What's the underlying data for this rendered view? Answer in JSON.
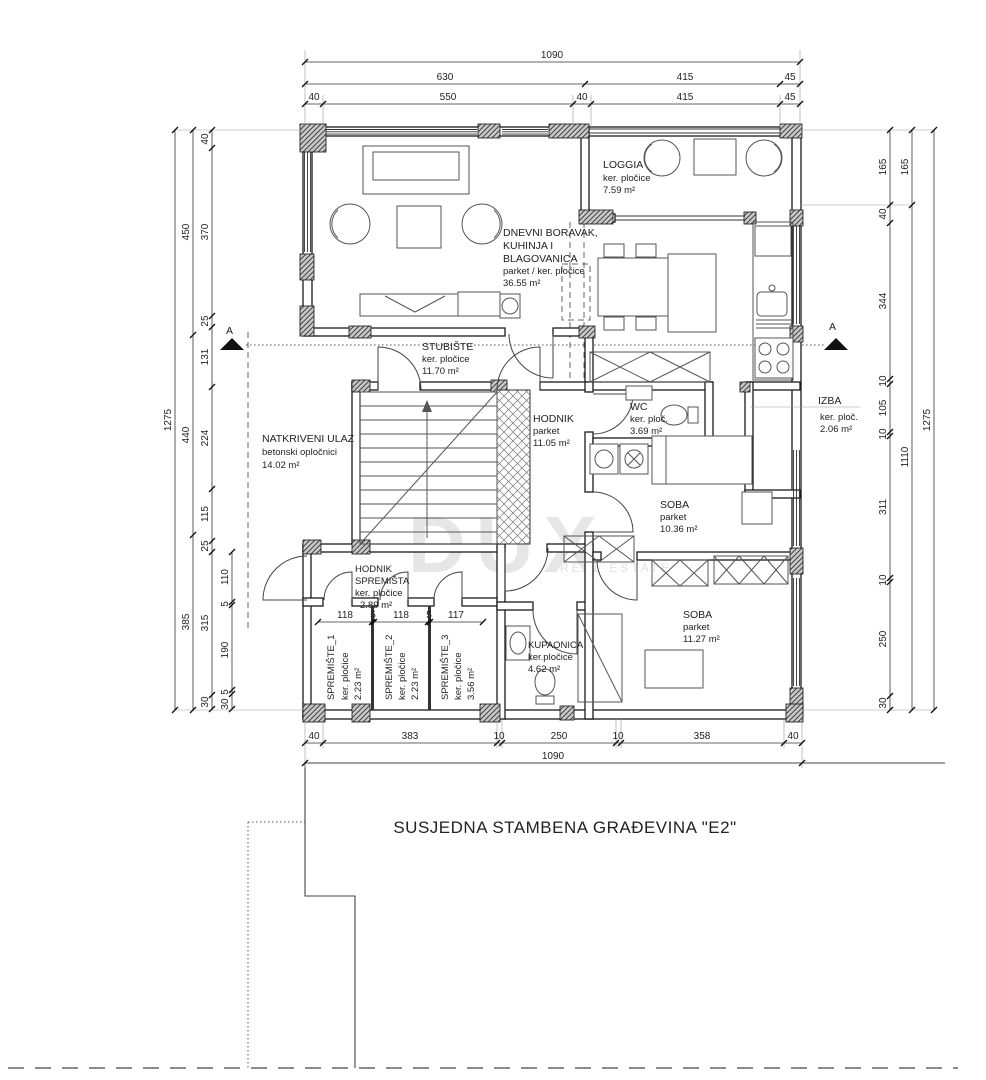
{
  "rooms": {
    "loggia": {
      "name": "LOGGIA",
      "floor": "ker. pločice",
      "area": "7.59 m²"
    },
    "living": {
      "name1": "DNEVNI BORAVAK,",
      "name2": "KUHINJA I",
      "name3": "BLAGOVANICA",
      "floor": "parket / ker. pločice",
      "area": "36.55 m²"
    },
    "stubiste": {
      "name": "STUBIŠTE",
      "floor": "ker. pločice",
      "area": "11.70 m²"
    },
    "natkriveni_ulaz": {
      "name": "NATKRIVENI ULAZ",
      "floor": "betonski opločnici",
      "area": "14.02 m²"
    },
    "hodnik": {
      "name": "HODNIK",
      "floor": "parket",
      "area": "11.05 m²"
    },
    "wc": {
      "name": "WC",
      "floor": "ker. ploč.",
      "area": "3.69 m²"
    },
    "izba": {
      "name": "IZBA",
      "floor": "ker. ploč.",
      "area": "2.06 m²"
    },
    "soba1": {
      "name": "SOBA",
      "floor": "parket",
      "area": "10.36 m²"
    },
    "soba2": {
      "name": "SOBA",
      "floor": "parket",
      "area": "11.27 m²"
    },
    "kupaonica": {
      "name": "KUPAONICA",
      "floor": "ker.pločice",
      "area": "4.62 m²"
    },
    "hodnik_spremista": {
      "name1": "HODNIK",
      "name2": "SPREMIŠTA",
      "floor": "ker. pločice",
      "area": "2.89 m²"
    },
    "spremiste1": {
      "name": "SPREMIŠTE_1",
      "floor": "ker. pločice",
      "area": "2.23 m²"
    },
    "spremiste2": {
      "name": "SPREMIŠTE_2",
      "floor": "ker. pločice",
      "area": "2.23 m²"
    },
    "spremiste3": {
      "name": "SPREMIŠTE_3",
      "floor": "ker. pločice",
      "area": "3.56 m²"
    }
  },
  "dimensions": {
    "top": {
      "row1": [
        "1090"
      ],
      "row2": [
        "630",
        "415",
        "45"
      ],
      "row3": [
        "40",
        "550",
        "40",
        "415",
        "45"
      ]
    },
    "bottom": {
      "row1": [
        "40",
        "383",
        "10",
        "250",
        "10",
        "358",
        "40"
      ],
      "row2": [
        "1090"
      ]
    },
    "left": {
      "outer": [
        "1275"
      ],
      "mid": [
        "450",
        "440",
        "385"
      ],
      "inner": [
        "40",
        "370",
        "25",
        "131",
        "224",
        "115",
        "25",
        "315",
        "30"
      ],
      "inner2": [
        "110",
        "5",
        "190",
        "5",
        "30"
      ]
    },
    "right": {
      "inner": [
        "165",
        "40",
        "344",
        "10",
        "105",
        "10",
        "311",
        "10",
        "250",
        "30"
      ],
      "mid": [
        "165",
        "1110"
      ],
      "outer": [
        "1275"
      ]
    },
    "spremiste": [
      "118",
      "5",
      "118",
      "5",
      "117"
    ]
  },
  "annotations": {
    "section_label": "A",
    "neighbor_text": "SUSJEDNA STAMBENA GRAĐEVINA \"E2\"",
    "watermark": "DUX",
    "watermark_sub": "REAL ESTATE"
  }
}
